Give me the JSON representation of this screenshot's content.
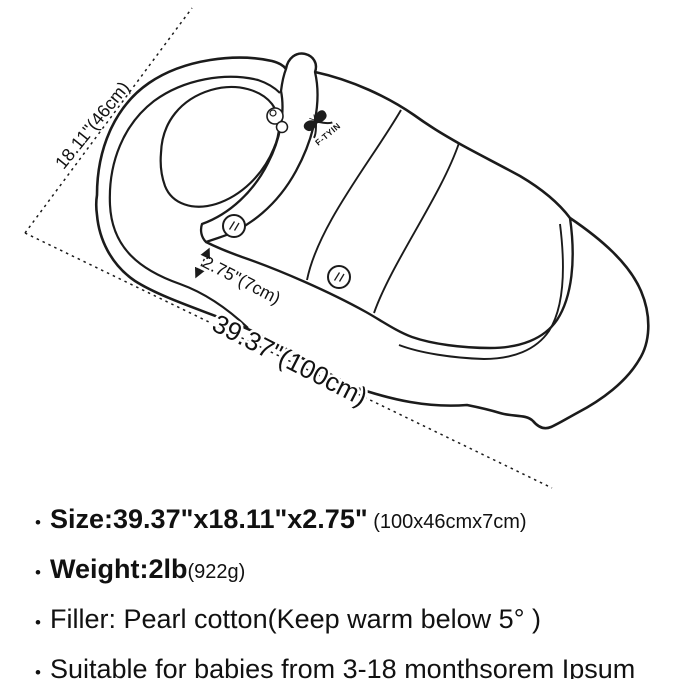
{
  "diagram": {
    "brand": "F-TYIN",
    "length_label": "39.37\"(100cm)",
    "width_label": "18.11\"(46cm)",
    "depth_label": "2.75\"(7cm)",
    "line_color": "#1b1b1b"
  },
  "specs": {
    "items": [
      {
        "bullet": "•",
        "strong": "Size:39.37\"x18.11\"x2.75\"",
        "note": " (100x46cmx7cm)",
        "text": ""
      },
      {
        "bullet": "•",
        "strong": "Weight:2lb",
        "note": "(922g)",
        "text": ""
      },
      {
        "bullet": "•",
        "strong": "",
        "note": "",
        "text": "Filler: Pearl cotton(Keep warm below 5° )"
      },
      {
        "bullet": "•",
        "strong": "",
        "note": "",
        "text": "Suitable for babies from 3-18 monthsorem Ipsum"
      }
    ]
  }
}
